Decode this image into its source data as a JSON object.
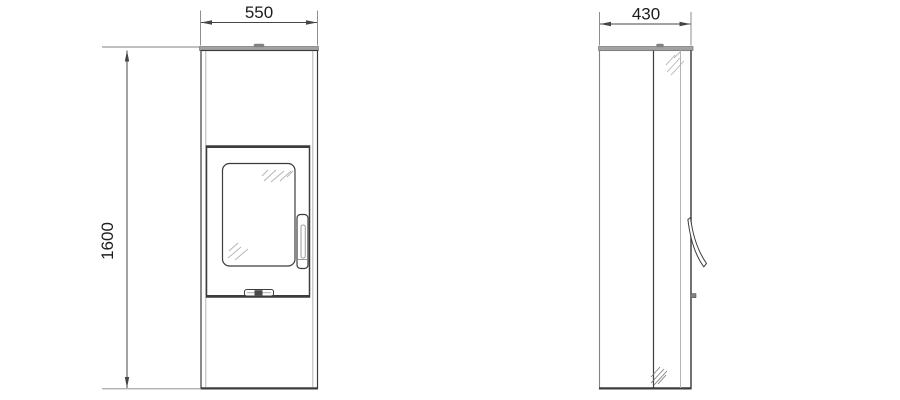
{
  "dims": {
    "width": "550",
    "depth": "430",
    "height": "1600"
  },
  "colors": {
    "background": "#ffffff",
    "line_dark": "#3c3c3c",
    "line_medium": "#828282",
    "line_light": "#b3b3b3",
    "plate_fill": "#a2a2a2",
    "knob_fill": "#4a4a4a",
    "dim_line": "#454545",
    "dim_text": "#1d1d1d"
  }
}
